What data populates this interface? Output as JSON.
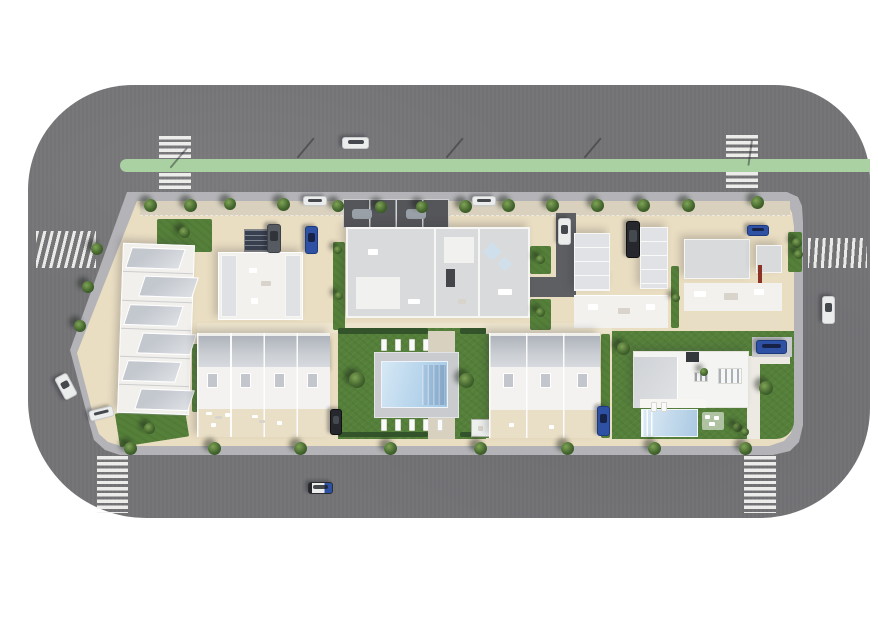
{
  "scene": {
    "title": "aerial-site-plan-render",
    "description": "Top-down 3D render of a residential block with apartment buildings, townhouses, communal pool, villa, ring road with bike lane, crosswalks, trees and cars",
    "background_color": "#ffffff",
    "colors": {
      "road": "#747477",
      "drive": "#5e5f63",
      "bike": "#a9d1a1",
      "sidewalk": "#b4b4b8",
      "ground": "#e9ddc2",
      "ground_shade": "#d9d1be",
      "path": "#d8d1bf",
      "lawn": "#55803a",
      "hedge": "#33532a",
      "deck": "#c9cbce",
      "roof_light": "#d9dadc",
      "roof_dark": "#55565a",
      "solar": "#394050",
      "red_accent": "#8a3326",
      "tree_light": "#7fa356",
      "tree_dark": "#2c4a20",
      "pool_light": "#d6e8f5",
      "pool_dark": "#a3c8e3"
    },
    "areas": [
      "terraced-townhouse-row-west",
      "apartment-nw",
      "apartment-north-main",
      "carport-row",
      "apartment-ne",
      "apartment-far-ne",
      "townhouse-row-sw",
      "communal-lawn",
      "swimming-pool",
      "townhouse-row-s",
      "villa-garden",
      "villa",
      "villa-pool",
      "ring-road",
      "bike-lane"
    ],
    "crosswalks": [
      {
        "name": "crosswalk-north-west",
        "t": "ladder",
        "x": 159,
        "y": 136,
        "w": 32,
        "h": 56
      },
      {
        "name": "crosswalk-north-east",
        "t": "ladder",
        "x": 726,
        "y": 135,
        "w": 32,
        "h": 55
      },
      {
        "name": "crosswalk-south-west",
        "t": "ladder",
        "x": 97,
        "y": 456,
        "w": 31,
        "h": 57
      },
      {
        "name": "crosswalk-south-east",
        "t": "ladder",
        "x": 744,
        "y": 456,
        "w": 32,
        "h": 57
      },
      {
        "name": "crosswalk-west",
        "t": "rungs",
        "x": 36,
        "y": 231,
        "w": 60,
        "h": 37
      },
      {
        "name": "crosswalk-east",
        "t": "rungs2",
        "x": 808,
        "y": 238,
        "w": 59,
        "h": 30
      }
    ],
    "lamps": [
      [
        186,
        148,
        40
      ],
      [
        313,
        138,
        40
      ],
      [
        462,
        138,
        40
      ],
      [
        600,
        138,
        40
      ],
      [
        751,
        140,
        8
      ]
    ],
    "trees": [
      [
        150,
        205,
        13
      ],
      [
        190,
        205,
        13
      ],
      [
        230,
        204,
        12
      ],
      [
        283,
        204,
        13
      ],
      [
        338,
        206,
        12
      ],
      [
        381,
        207,
        12
      ],
      [
        422,
        207,
        12
      ],
      [
        465,
        206,
        13
      ],
      [
        508,
        205,
        13
      ],
      [
        552,
        205,
        13
      ],
      [
        597,
        205,
        13
      ],
      [
        643,
        205,
        13
      ],
      [
        688,
        205,
        13
      ],
      [
        757,
        202,
        13
      ],
      [
        97,
        249,
        12
      ],
      [
        88,
        287,
        12
      ],
      [
        80,
        326,
        12
      ],
      [
        130,
        448,
        13
      ],
      [
        214,
        448,
        13
      ],
      [
        300,
        448,
        13
      ],
      [
        390,
        448,
        13
      ],
      [
        480,
        448,
        13
      ],
      [
        567,
        448,
        13
      ],
      [
        654,
        448,
        13
      ],
      [
        745,
        448,
        13
      ],
      [
        357,
        380,
        16
      ],
      [
        466,
        380,
        15
      ],
      [
        184,
        232,
        11
      ],
      [
        149,
        428,
        11
      ],
      [
        540,
        259,
        9
      ],
      [
        540,
        312,
        9
      ],
      [
        676,
        298,
        8
      ],
      [
        797,
        243,
        10
      ],
      [
        798,
        254,
        9
      ],
      [
        623,
        348,
        13
      ],
      [
        766,
        388,
        14
      ],
      [
        737,
        427,
        9
      ],
      [
        745,
        432,
        8
      ],
      [
        704,
        372,
        8
      ],
      [
        338,
        250,
        8
      ],
      [
        339,
        296,
        8
      ]
    ],
    "cars": [
      {
        "name": "car-top-road",
        "c": "white",
        "x": 342,
        "y": 137,
        "w": 27,
        "h": 12,
        "r": 0
      },
      {
        "name": "car-parked-top-west",
        "c": "white",
        "x": 303,
        "y": 196,
        "w": 24,
        "h": 10,
        "r": 0
      },
      {
        "name": "car-parked-top-mid",
        "c": "white",
        "x": 472,
        "y": 196,
        "w": 24,
        "h": 10,
        "r": 0
      },
      {
        "name": "van-parked-courtyard-nw",
        "c": "gray",
        "x": 267,
        "y": 224,
        "w": 14,
        "h": 29,
        "r": 0
      },
      {
        "name": "car-parked-courtyard-nw",
        "c": "blue",
        "x": 305,
        "y": 226,
        "w": 13,
        "h": 28,
        "r": 0
      },
      {
        "name": "car-driveway-north",
        "c": "white",
        "x": 558,
        "y": 218,
        "w": 13,
        "h": 27,
        "r": 0
      },
      {
        "name": "van-parked-courtyard-ne",
        "c": "dark",
        "x": 626,
        "y": 221,
        "w": 14,
        "h": 37,
        "r": 0
      },
      {
        "name": "car-parked-ne",
        "c": "blue",
        "x": 747,
        "y": 225,
        "w": 22,
        "h": 11,
        "r": 0
      },
      {
        "name": "car-left-road",
        "c": "white",
        "x": 59,
        "y": 374,
        "w": 14,
        "h": 25,
        "r": -28
      },
      {
        "name": "car-parked-west-bay",
        "c": "white",
        "x": 89,
        "y": 408,
        "w": 25,
        "h": 11,
        "r": -14
      },
      {
        "name": "car-bottom-road",
        "c": "police",
        "x": 308,
        "y": 482,
        "w": 25,
        "h": 12,
        "r": 0
      },
      {
        "name": "car-parked-sw-drive",
        "c": "dark",
        "x": 330,
        "y": 409,
        "w": 12,
        "h": 26,
        "r": 0
      },
      {
        "name": "car-parked-s-drive",
        "c": "blue",
        "x": 597,
        "y": 406,
        "w": 13,
        "h": 30,
        "r": 0
      },
      {
        "name": "car-villa-drive",
        "c": "blue",
        "x": 756,
        "y": 340,
        "w": 31,
        "h": 14,
        "r": 0
      },
      {
        "name": "car-right-road",
        "c": "white",
        "x": 822,
        "y": 296,
        "w": 13,
        "h": 28,
        "r": 0
      }
    ],
    "loungers": {
      "rows": [
        {
          "name": "pool-loungers-north",
          "y": 339,
          "h": 12,
          "xs": [
            381,
            395,
            409,
            423
          ]
        },
        {
          "name": "pool-loungers-south",
          "y": 419,
          "h": 12,
          "xs": [
            381,
            395,
            409,
            423,
            437
          ]
        },
        {
          "name": "villa-loungers",
          "y": 402,
          "h": 10,
          "xs": [
            651,
            661
          ]
        }
      ]
    }
  }
}
